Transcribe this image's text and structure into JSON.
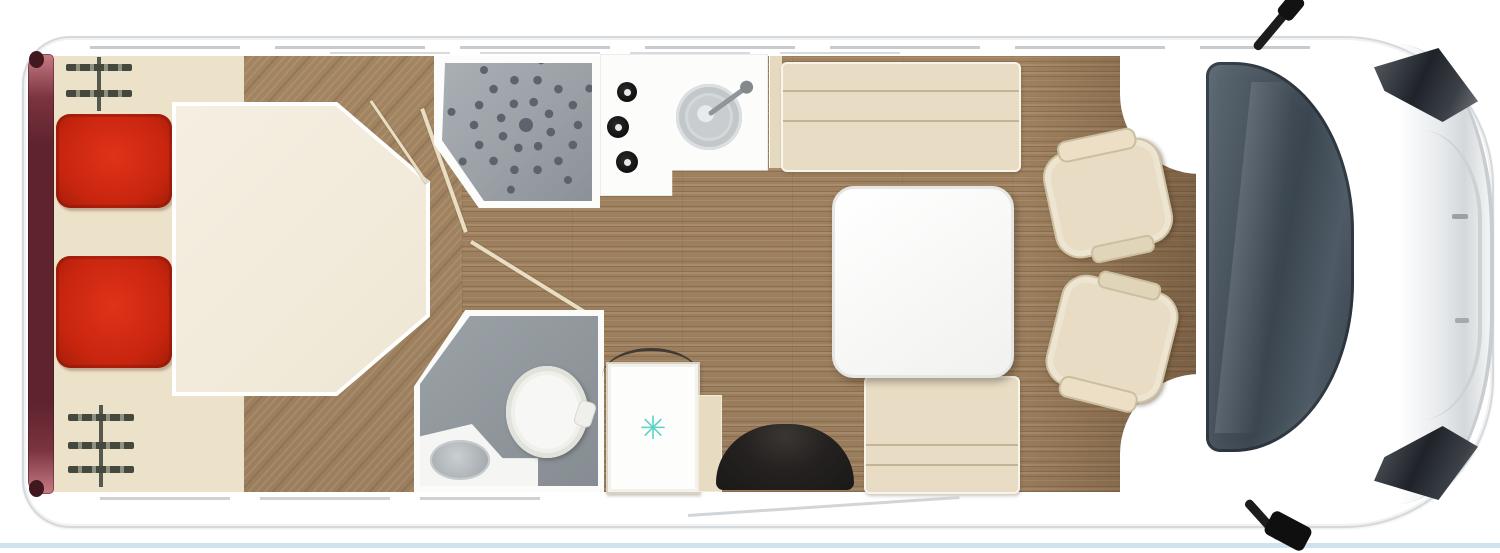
{
  "floorplan": {
    "type": "motorhome-top-view-floorplan",
    "orientation": "cab-on-right",
    "fridge": {
      "snowflake_glyph": "✳"
    },
    "fixture_counts": {
      "bed_pillows": 2,
      "hob_burners": 3,
      "cab_seats": 2,
      "access_ladders": 2,
      "dinette_benches": 2
    },
    "colors": {
      "pillow_red": "#c8250f",
      "rear_band_maroon": "#5e232d",
      "cream_floor": "#ece1c9",
      "wood_floor": "#a88a66",
      "upholstery_cream": "#e8ddc4",
      "shower_tray_gray": "#9aa0a5",
      "bathroom_floor_gray": "#868d92",
      "windshield_slate": "#3a454f",
      "snowflake_teal": "#5ed2c6",
      "step_black": "#1b1918",
      "bottom_edge_blue": "#cfe3ee"
    }
  }
}
